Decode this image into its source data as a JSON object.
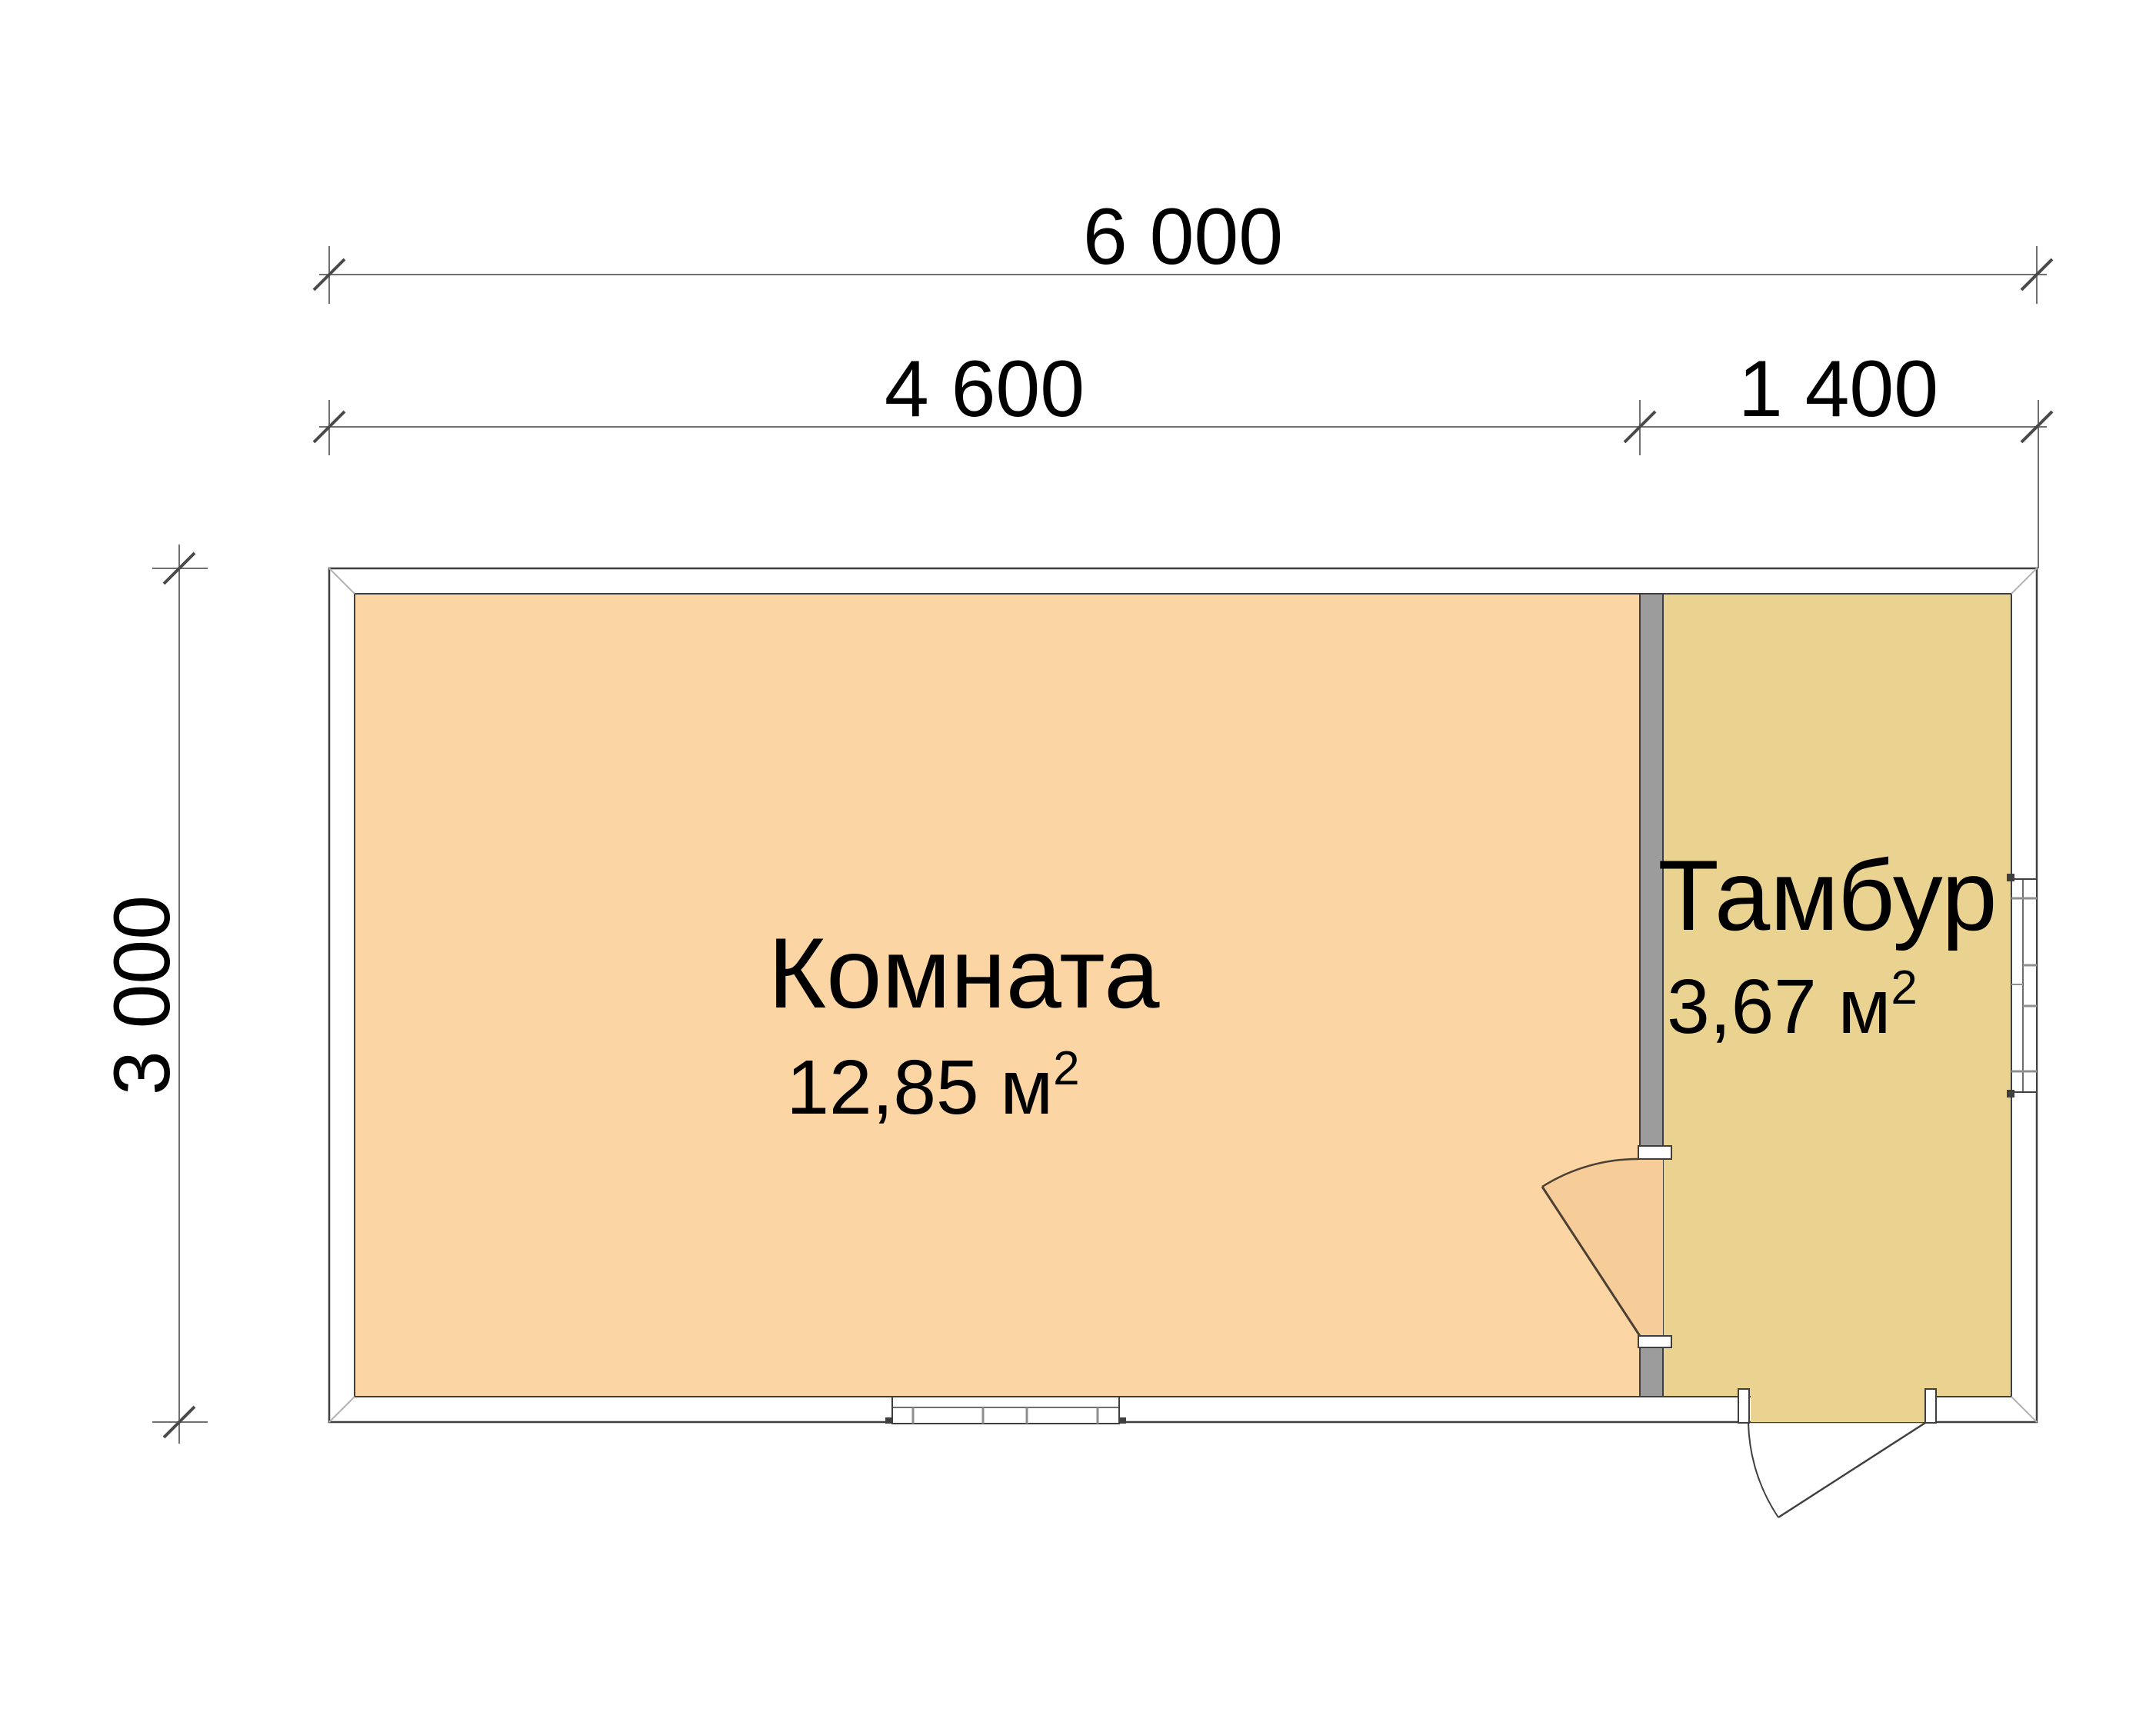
{
  "plan": {
    "type": "floor-plan",
    "dimensions": {
      "total_width_mm": "6 000",
      "room_width_mm": "4 600",
      "tambour_width_mm": "1 400",
      "depth_mm": "3 000"
    },
    "rooms": [
      {
        "name": "Комната",
        "area": "12,85 м",
        "area_sup": "2"
      },
      {
        "name": "Тамбур",
        "area": "3,67 м",
        "area_sup": "2"
      }
    ],
    "colors": {
      "room_fill": "#FBD5A4",
      "door_swing_fill": "#F6CC99",
      "tambour_fill": "#EAD291",
      "wall_fill": "#9C9C9C",
      "outline": "#3F3F3F",
      "dimension_line": "#707070",
      "text": "#000000"
    }
  }
}
